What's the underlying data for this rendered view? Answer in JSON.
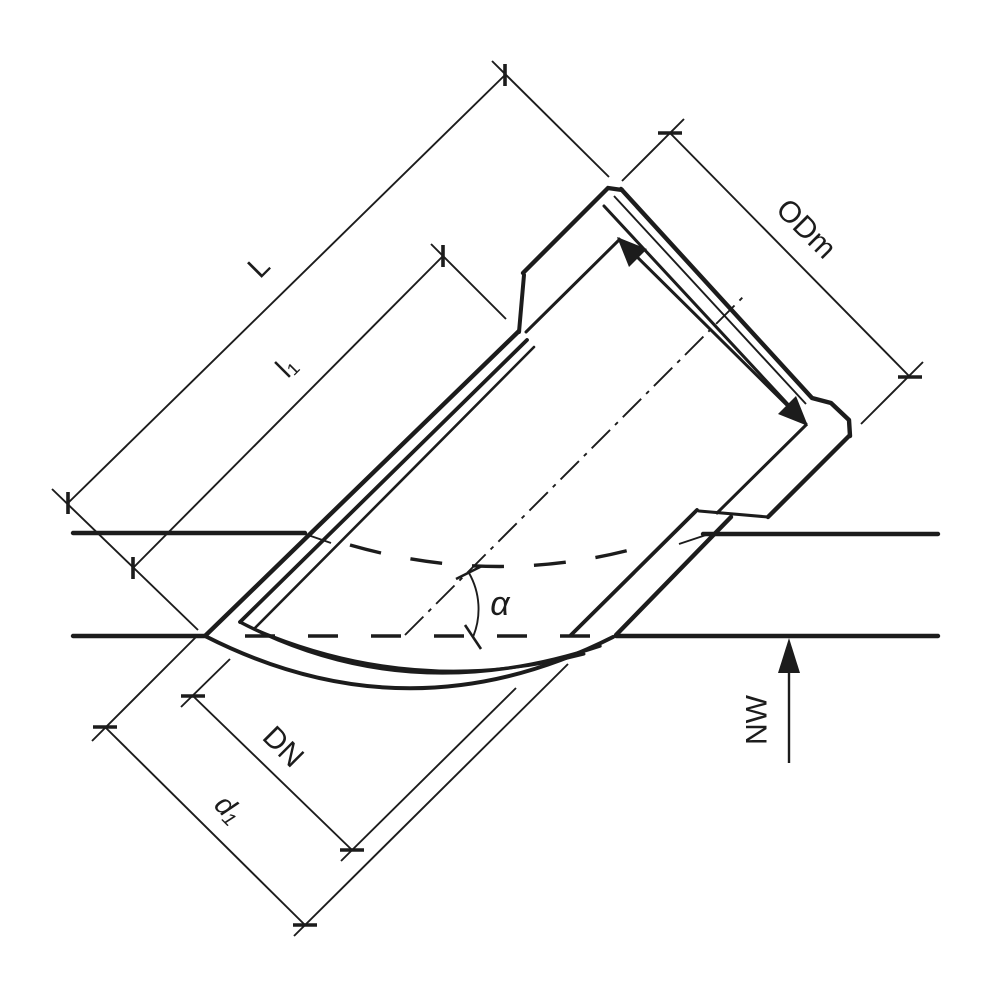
{
  "diagram": {
    "title": "45-degree saddle branch pipe fitting - dimensioned technical drawing",
    "labels": {
      "overall_length": "L",
      "insertion_length": "l₁",
      "socket_mean_outside_diameter": "ODm",
      "nominal_diameter": "DN",
      "saddle_outside_diameter": "d₁",
      "branch_angle": "α",
      "flow_direction": "NW"
    },
    "colors": {
      "line": "#1c1c1c",
      "background": "#ffffff"
    }
  }
}
